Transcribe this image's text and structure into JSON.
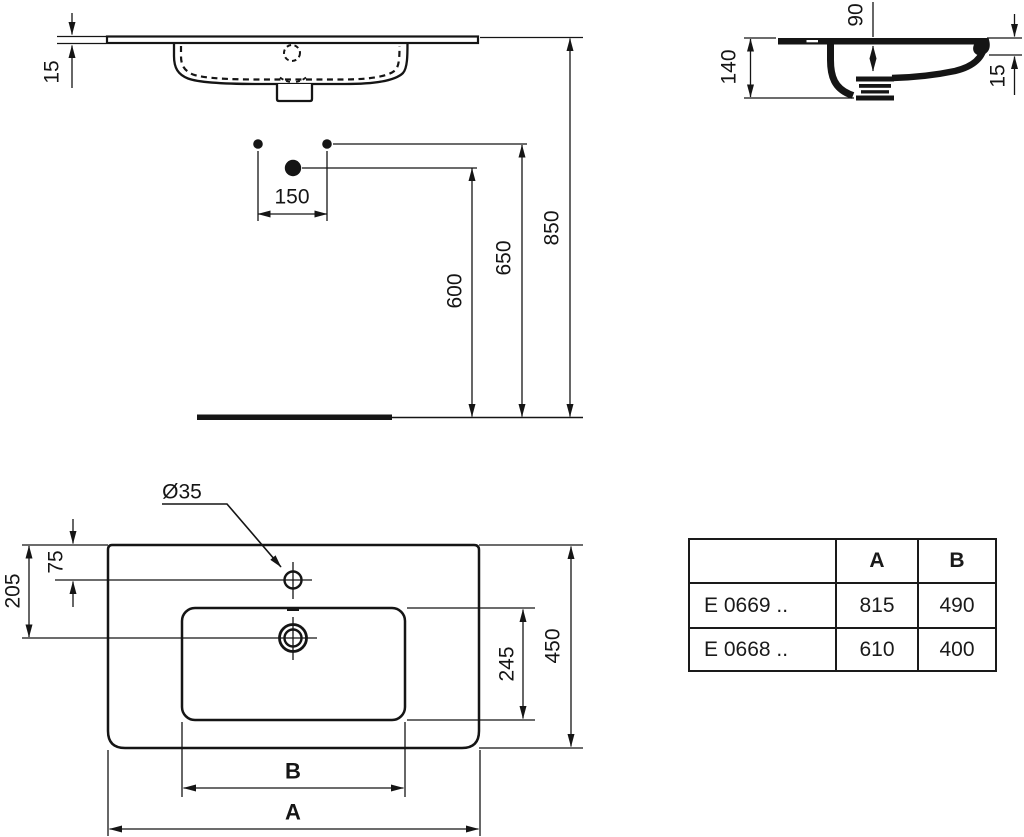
{
  "dimensions": {
    "front": {
      "rim_thickness": "15"
    },
    "installation": {
      "tap_hole_spacing": "150",
      "waste_height": "600",
      "fixing_height": "650",
      "rim_height": "850"
    },
    "side": {
      "basin_depth": "140",
      "bowl_depth": "90",
      "front_edge_thickness": "15"
    },
    "plan": {
      "tap_hole_diameter": "Ø35",
      "tap_hole_offset": "75",
      "waste_offset": "205",
      "bowl_front_back": "245",
      "overall_depth": "450",
      "overall_width_label": "A",
      "bowl_width_label": "B"
    }
  },
  "table": {
    "headers": {
      "model": "",
      "a": "A",
      "b": "B"
    },
    "rows": [
      {
        "model": "E 0669 ..",
        "a": "815",
        "b": "490"
      },
      {
        "model": "E 0668 ..",
        "a": "610",
        "b": "400"
      }
    ]
  }
}
